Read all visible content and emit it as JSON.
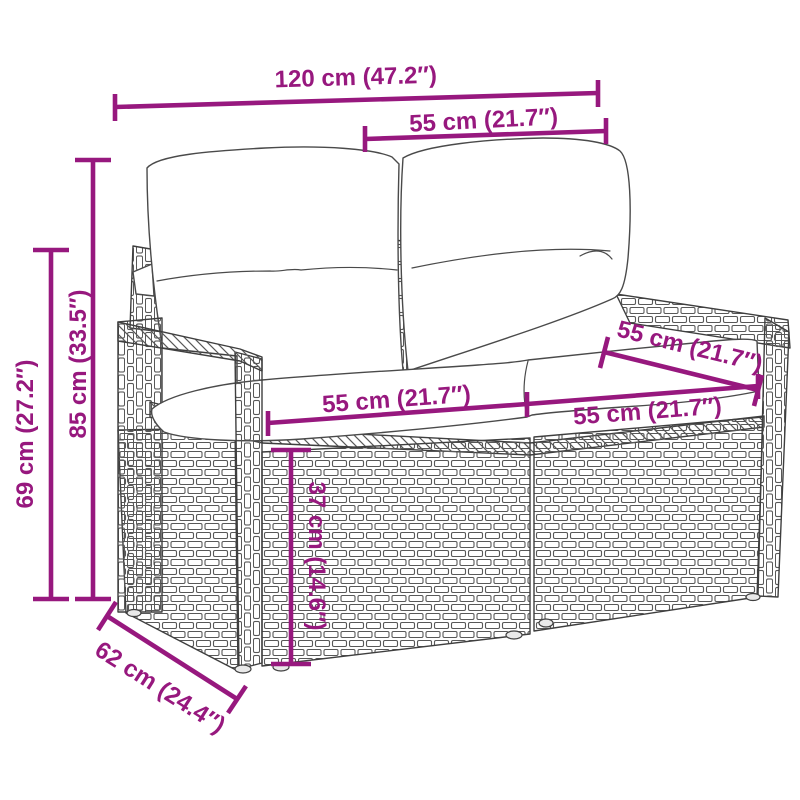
{
  "diagram": {
    "subject": "poly rattan 2-seater garden bench with cushions",
    "accent_color": "#97187E",
    "labels": {
      "total_width": "120 cm (47.2″)",
      "backrest_width": "55 cm (21.7″)",
      "total_height": "85 cm (33.5″)",
      "armrest_height": "69 cm (27.2″)",
      "seat_width_left": "55 cm (21.7″)",
      "seat_width_right": "55 cm (21.7″)",
      "seat_depth": "55 cm (21.7″)",
      "seat_height": "37 cm (14.6″)",
      "total_depth": "62 cm (24.4″)"
    }
  }
}
